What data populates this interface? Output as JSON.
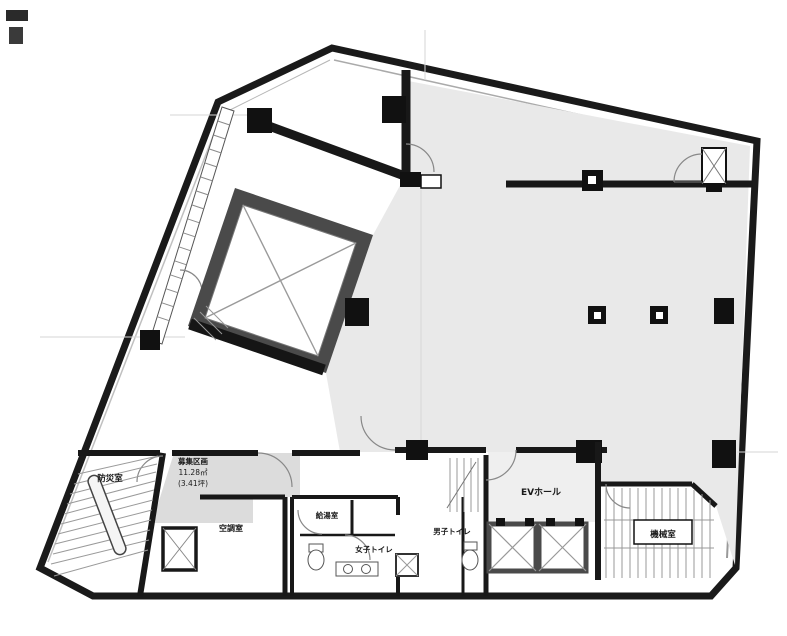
{
  "document": {
    "kind": "architectural-floor-plan",
    "language": "ja"
  },
  "plan": {
    "rooms": [
      {
        "id": "bousai-shitsu",
        "label": "防災室"
      },
      {
        "id": "boshu-kukaku",
        "label": "募集区画",
        "area_m2": "11.28㎡",
        "area_tsubo": "(3.41坪)"
      },
      {
        "id": "kucho-shitsu",
        "label": "空調室"
      },
      {
        "id": "kyuto-shitsu",
        "label": "給湯室"
      },
      {
        "id": "joshi-toilet",
        "label": "女子トイレ"
      },
      {
        "id": "danshi-toilet",
        "label": "男子トイレ"
      },
      {
        "id": "ev-hall",
        "label": "EVホール"
      },
      {
        "id": "kikai-shitsu",
        "label": "機械室"
      }
    ],
    "features": {
      "elevators": 2,
      "staircases": 2,
      "central_void_shaft": 1
    },
    "colors": {
      "wall": "#1a1a1a",
      "shaft_wall": "#4a4a4a",
      "floor_main": "#e9e9e9",
      "floor_unit": "#dcdcdc",
      "hatch_line": "#8a8a8a",
      "faint_line": "#d6d6d6"
    }
  }
}
